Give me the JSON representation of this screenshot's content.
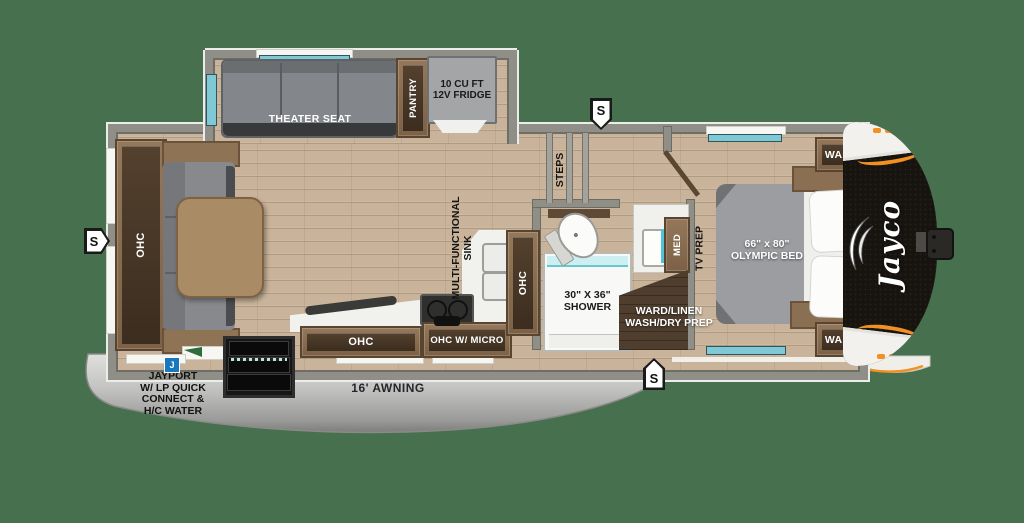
{
  "colors": {
    "background": "#47704E",
    "floor": "#C9B49B",
    "wall": "#8F8F88",
    "cabinet": "#8A6F52",
    "counter": "#F1F1EE",
    "shower_glass": "#CDEFF2",
    "skirt": "#C9C9C7",
    "cap_black": "#17140F",
    "accent_orange": "#F29022",
    "badge_blue": "#1878BE"
  },
  "slide": {
    "theater_seat": "THEATER SEAT",
    "pantry": "PANTRY",
    "fridge_line1": "10 CU FT",
    "fridge_line2": "12V FRIDGE"
  },
  "living": {
    "ohc": "OHC"
  },
  "kitchen": {
    "sink_label_line1": "MULTI-FUNCTIONAL",
    "sink_label_line2": "SINK",
    "ohc": "OHC",
    "ohc_micro": "OHC W/ MICRO",
    "ohc_tall": "OHC"
  },
  "bath": {
    "steps": "STEPS",
    "shower_line1": "30\" X 36\"",
    "shower_line2": "SHOWER",
    "med": "MED",
    "ward_linen_line1": "WARD/LINEN",
    "ward_linen_line2": "WASH/DRY PREP"
  },
  "bedroom": {
    "bed_line1": "66\" x 80\"",
    "bed_line2": "OLYMPIC BED",
    "ward_top": "WARD",
    "ward_bottom": "WARD",
    "tv_prep": "TV PREP"
  },
  "exterior": {
    "awning": "16' AWNING",
    "jayport_line1": "JAYPORT",
    "jayport_line2": "W/ LP QUICK",
    "jayport_line3": "CONNECT &",
    "jayport_line4": "H/C WATER",
    "j_badge": "J",
    "marker": "S",
    "brand": "Jayco"
  }
}
